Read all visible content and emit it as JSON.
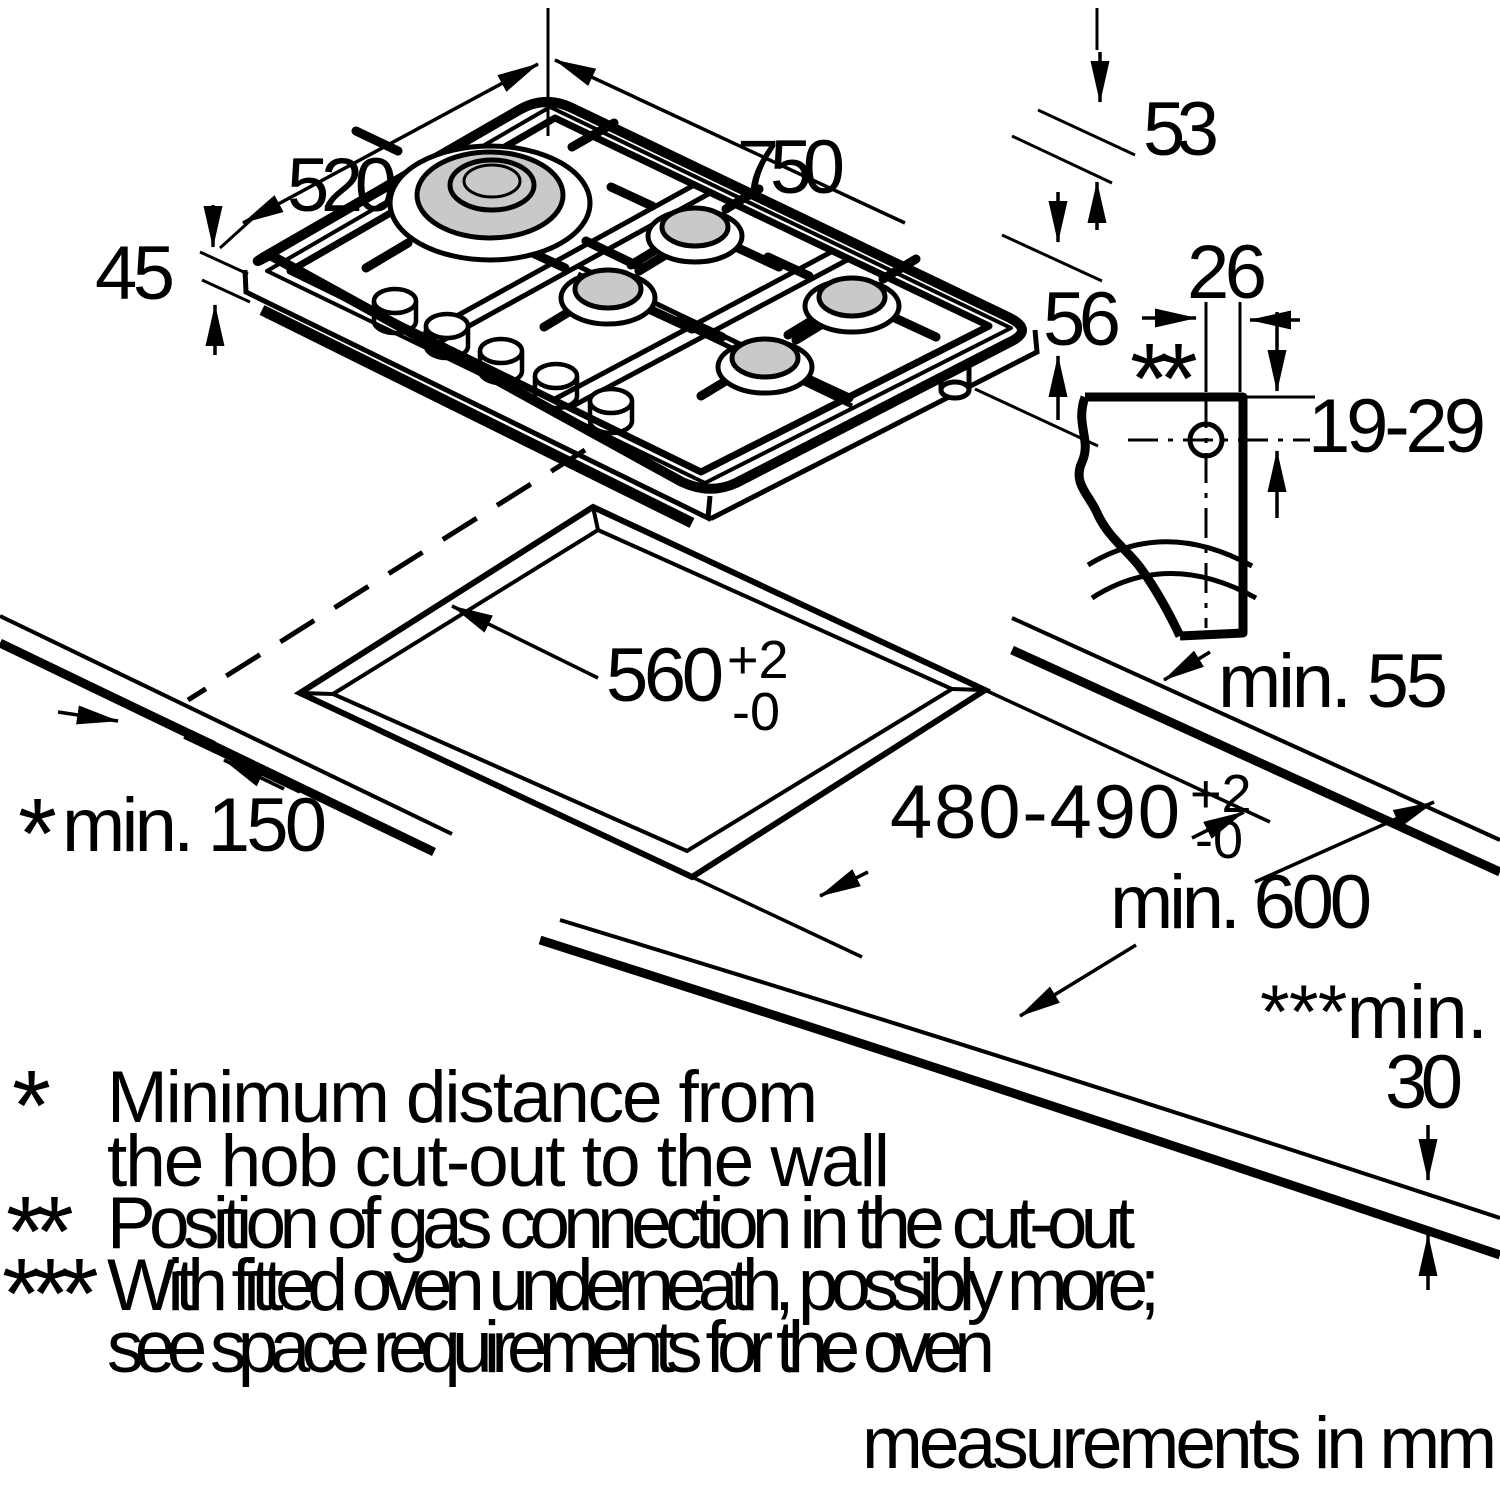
{
  "labels": {
    "w750": "750",
    "d520": "520",
    "h45": "45",
    "h53": "53",
    "h56": "56",
    "w26": "26",
    "v19_29": "19-29",
    "min55": "min. 55",
    "c560": "560",
    "c560_sup": "+2",
    "c560_sub": "-0",
    "c480": "480-490",
    "c480_sup": "+2",
    "c480_sub": "-0",
    "min150_marker": "*",
    "min150": "min. 150",
    "min600": "min. 600",
    "min30_prefix": "***min.",
    "min30_value": "30",
    "gas_marker": "**",
    "units": "measurements in mm"
  },
  "footnotes": [
    {
      "marker": "*",
      "lines": [
        "Minimum distance from",
        "the hob cut-out to the wall"
      ]
    },
    {
      "marker": "**",
      "lines": [
        "Position of gas connection in the cut-out"
      ]
    },
    {
      "marker": "***",
      "lines": [
        "With fitted oven underneath, possibly more;",
        "see space requirements for the oven"
      ]
    }
  ]
}
